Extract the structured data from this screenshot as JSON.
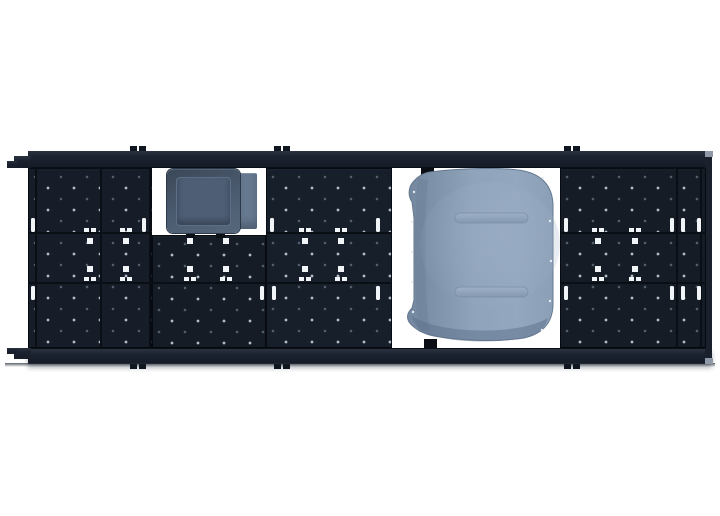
{
  "title": "Modular roof rack platform — top view with roof fan and pop-top vent cutouts",
  "canvas": {
    "width": 720,
    "height": 516,
    "background": "#ffffff"
  },
  "colors": {
    "background": "#ffffff",
    "deck": "#161d28",
    "seam": "#0a0e15",
    "rail": "#1b2230",
    "slot": "#f2f5f8",
    "dot": "#cdd7e4",
    "cap": "#8e98a6",
    "tab": "#0a0e14",
    "fanBody": "#4c5c70",
    "fanLid": "#4e5e74",
    "fanFlange": "#66798f",
    "popMain": "#8da1ba",
    "popLight": "#9cafc6",
    "popEdge": "#6e839e",
    "popShadow": "#5c7089"
  },
  "scene": {
    "description": "Top-down render of a black modular roof-rack platform with perforated slat panels, white tie-down slots, and two white cutouts: a small roof fan on the left and a large pop-top vent cover on the right.",
    "parts": [
      {
        "label": "roof-rack-platform"
      },
      {
        "label": "front-rail"
      },
      {
        "label": "rear-rail"
      },
      {
        "label": "fan-cutout"
      },
      {
        "label": "roof-fan",
        "color": "#4e5e74"
      },
      {
        "label": "pop-top-cutout"
      },
      {
        "label": "pop-top-cover",
        "color": "#8da1ba"
      }
    ],
    "fixtures": {
      "slots": [
        [
          31,
          218
        ],
        [
          142,
          218
        ],
        [
          270,
          218
        ],
        [
          376,
          218
        ],
        [
          564,
          218
        ],
        [
          670,
          218
        ],
        [
          681,
          218
        ],
        [
          697,
          218
        ],
        [
          31,
          286
        ],
        [
          260,
          286
        ],
        [
          272,
          286
        ],
        [
          376,
          286
        ],
        [
          564,
          286
        ],
        [
          670,
          286
        ],
        [
          681,
          286
        ],
        [
          697,
          286
        ]
      ],
      "clamps": [
        90,
        126,
        190,
        226,
        305,
        341,
        598,
        635
      ],
      "rail_tabs": [
        138,
        282,
        572
      ],
      "mount_tabs": [
        [
          421,
          168
        ],
        [
          424,
          339
        ]
      ],
      "fan_feet": [
        [
          186,
          233
        ],
        [
          216,
          233
        ]
      ]
    }
  }
}
